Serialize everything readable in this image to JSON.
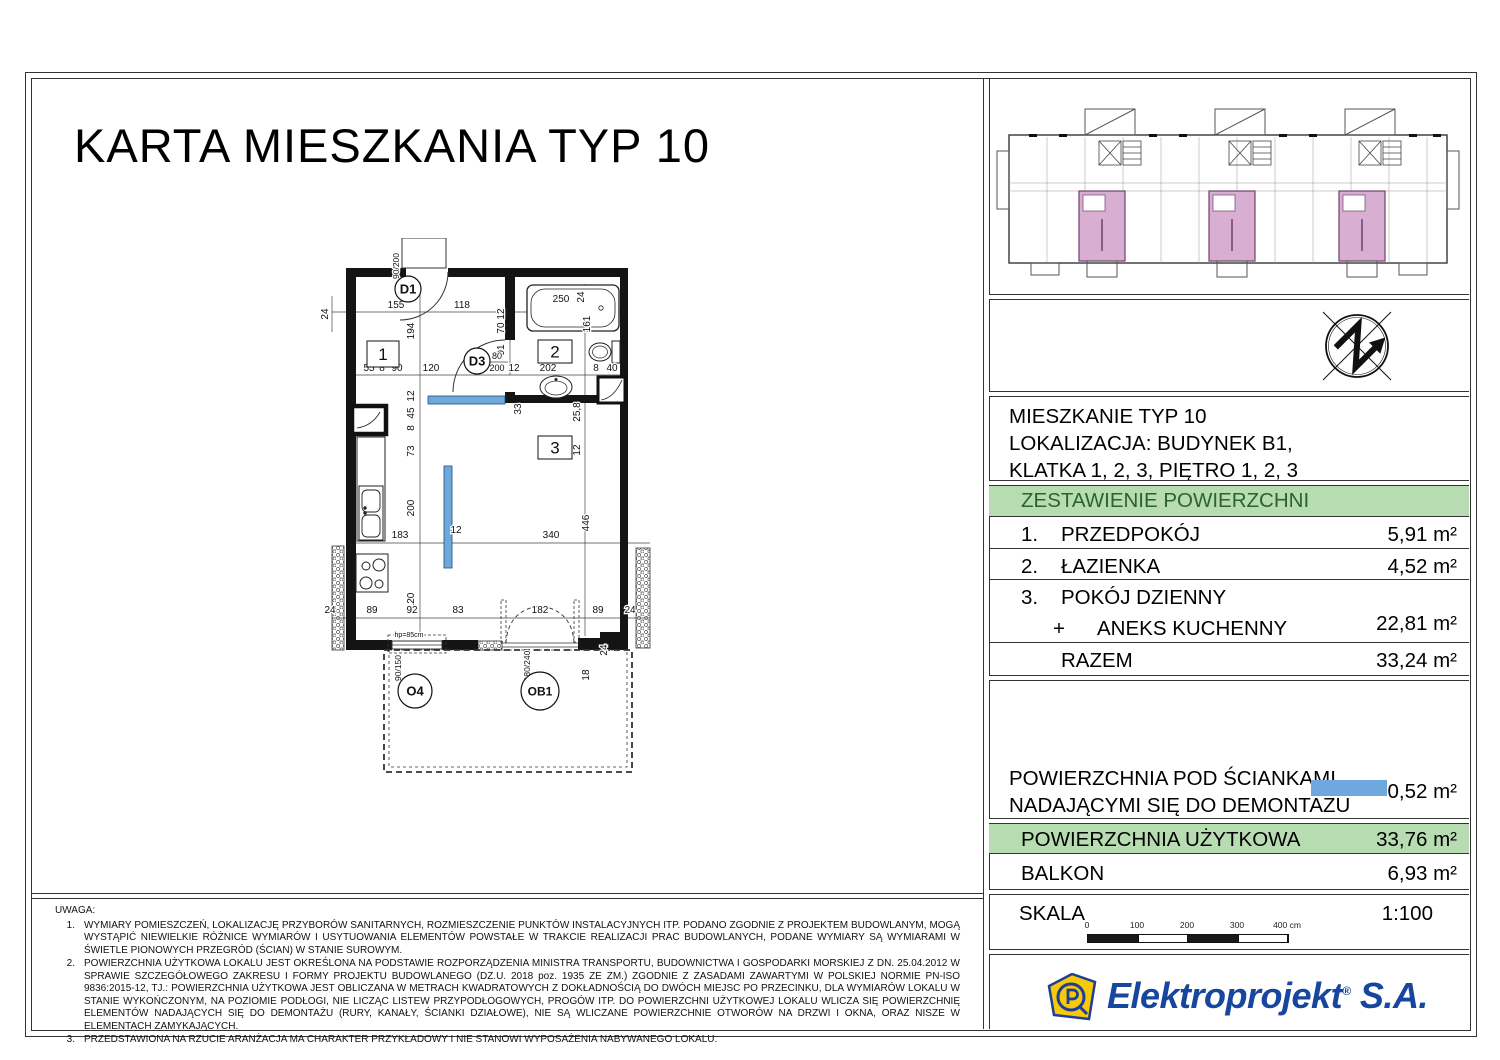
{
  "title": "KARTA MIESZKANIA TYP 10",
  "info": {
    "line1": "MIESZKANIE TYP 10",
    "line2": "LOKALIZACJA: BUDYNEK B1,",
    "line3": "KLATKA 1, 2, 3, PIĘTRO 1, 2, 3"
  },
  "area_table": {
    "header": "ZESTAWIENIE POWIERZCHNI",
    "rows": [
      {
        "no": "1.",
        "name": "PRZEDPOKÓJ",
        "value": "5,91 m²"
      },
      {
        "no": "2.",
        "name": "ŁAZIENKA",
        "value": "4,52 m²"
      },
      {
        "no": "3.",
        "name": "POKÓJ DZIENNY",
        "plus": "+",
        "name2": "ANEKS KUCHENNY",
        "value": "22,81 m²"
      }
    ],
    "razem_label": "RAZEM",
    "razem_value": "33,24 m²"
  },
  "demontaz": {
    "line1": "POWIERZCHNIA POD ŚCIANKAMI",
    "line2": "NADAJĄCYMI SIĘ DO DEMONTAŻU",
    "value": "0,52 m²"
  },
  "summary": {
    "uzytkowa_label": "POWIERZCHNIA UŻYTKOWA",
    "uzytkowa_value": "33,76 m²",
    "balkon_label": "BALKON",
    "balkon_value": "6,93 m²"
  },
  "skala": {
    "label": "SKALA",
    "value": "1:100",
    "ticks": [
      "0",
      "100",
      "200",
      "300",
      "400 cm"
    ]
  },
  "logo": {
    "name": "Elektroprojekt",
    "reg": "®",
    "suffix": " S.A."
  },
  "notes": {
    "heading": "UWAGA:",
    "items": [
      {
        "no": "1.",
        "text": "WYMIARY POMIESZCZEŃ, LOKALIZACJĘ PRZYBORÓW SANITARNYCH, ROZMIESZCZENIE PUNKTÓW INSTALACYJNYCH ITP. PODANO ZGODNIE Z PROJEKTEM BUDOWLANYM, MOGĄ WYSTĄPIĆ NIEWIELKIE RÓŻNICE WYMIARÓW I USYTUOWANIA ELEMENTÓW POWSTAŁE W TRAKCIE REALIZACJI PRAC BUDOWLANYCH, PODANE WYMIARY SĄ WYMIARAMI W ŚWIETLE PIONOWYCH PRZEGRÓD (ŚCIAN) W STANIE SUROWYM."
      },
      {
        "no": "2.",
        "text": "POWIERZCHNIA UŻYTKOWA LOKALU JEST OKREŚLONA NA PODSTAWIE ROZPORZĄDZENIA MINISTRA TRANSPORTU, BUDOWNICTWA I GOSPODARKI MORSKIEJ Z DN. 25.04.2012 W SPRAWIE SZCZEGÓŁOWEGO ZAKRESU I FORMY PROJEKTU BUDOWLANEGO (DZ.U. 2018 poz. 1935 ZE ZM.) ZGODNIE Z ZASADAMI ZAWARTYMI W POLSKIEJ NORMIE PN-ISO 9836:2015-12, TJ.: POWIERZCHNIA UŻYTKOWA JEST OBLICZANA W METRACH KWADRATOWYCH Z DOKŁADNOŚCIĄ DO DWÓCH MIEJSC PO PRZECINKU, DLA WYMIARÓW LOKALU W STANIE WYKOŃCZONYM, NA POZIOMIE PODŁOGI, NIE LICZĄC LISTEW PRZYPODŁOGOWYCH, PROGÓW ITP. DO POWIERZCHNI UŻYTKOWEJ LOKALU WLICZA SIĘ POWIERZCHNIĘ ELEMENTÓW NADAJĄCYCH SIĘ DO DEMONTAŻU (RURY, KANAŁY, ŚCIANKI DZIAŁOWE), NIE SĄ WLICZANE POWIERZCHNIE OTWORÓW NA DRZWI I OKNA, ORAZ NISZE W ELEMENTACH ZAMYKAJĄCYCH."
      },
      {
        "no": "3.",
        "text": "PRZEDSTAWIONA NA RZUCIE ARANŻACJA MA CHARAKTER PRZYKŁADOWY I NIE STANOWI WYPOSAŻENIA NABYWANEGO LOKALU."
      }
    ]
  },
  "plan": {
    "rooms": [
      {
        "t": "1",
        "x": 367,
        "y": 341,
        "w": 32,
        "h": 26
      },
      {
        "t": "2",
        "x": 538,
        "y": 340,
        "w": 34,
        "h": 23
      },
      {
        "t": "3",
        "x": 538,
        "y": 436,
        "w": 34,
        "h": 23
      }
    ],
    "openings": [
      {
        "t": "D1",
        "x": 408,
        "y": 289,
        "rr": 13
      },
      {
        "t": "D3",
        "x": 477,
        "y": 361,
        "rr": 13
      },
      {
        "t": "O4",
        "x": 415,
        "y": 691,
        "rr": 17
      },
      {
        "t": "OB1",
        "x": 540,
        "y": 691,
        "rr": 19
      }
    ],
    "dims": [
      {
        "t": "24",
        "x": 328,
        "y": 314,
        "r": -90
      },
      {
        "t": "155",
        "x": 396,
        "y": 308
      },
      {
        "t": "118",
        "x": 462,
        "y": 308
      },
      {
        "t": "250",
        "x": 561,
        "y": 302
      },
      {
        "t": "24",
        "x": 584,
        "y": 297,
        "r": -90
      },
      {
        "t": "90/200",
        "x": 399,
        "y": 266,
        "r": -90,
        "s": 8.5
      },
      {
        "t": "194",
        "x": 414,
        "y": 331,
        "r": -90
      },
      {
        "t": "12",
        "x": 504,
        "y": 314,
        "r": -90
      },
      {
        "t": "70",
        "x": 504,
        "y": 328,
        "r": -90
      },
      {
        "t": "91",
        "x": 504,
        "y": 350,
        "r": -90
      },
      {
        "t": "161",
        "x": 590,
        "y": 324,
        "r": -90
      },
      {
        "t": "55",
        "x": 369,
        "y": 371
      },
      {
        "t": "8",
        "x": 382,
        "y": 371
      },
      {
        "t": "90",
        "x": 397,
        "y": 371
      },
      {
        "t": "120",
        "x": 431,
        "y": 371
      },
      {
        "t": "80",
        "x": 497,
        "y": 359,
        "s": 9
      },
      {
        "t": "200",
        "x": 497,
        "y": 371,
        "s": 9
      },
      {
        "t": "12",
        "x": 514,
        "y": 371
      },
      {
        "t": "202",
        "x": 548,
        "y": 371
      },
      {
        "t": "8",
        "x": 596,
        "y": 371
      },
      {
        "t": "40",
        "x": 612,
        "y": 371
      },
      {
        "t": "33",
        "x": 521,
        "y": 409,
        "r": -90
      },
      {
        "t": "25,8",
        "x": 580,
        "y": 412,
        "r": -90
      },
      {
        "t": "12",
        "x": 580,
        "y": 450,
        "r": -90
      },
      {
        "t": "12",
        "x": 414,
        "y": 396,
        "r": -90
      },
      {
        "t": "45",
        "x": 414,
        "y": 413,
        "r": -90
      },
      {
        "t": "8",
        "x": 414,
        "y": 428,
        "r": -90
      },
      {
        "t": "73",
        "x": 414,
        "y": 451,
        "r": -90
      },
      {
        "t": "200",
        "x": 414,
        "y": 508,
        "r": -90
      },
      {
        "t": "120",
        "x": 414,
        "y": 601,
        "r": -90
      },
      {
        "t": "446",
        "x": 589,
        "y": 523,
        "r": -90
      },
      {
        "t": "183",
        "x": 400,
        "y": 538
      },
      {
        "t": "12",
        "x": 456,
        "y": 533
      },
      {
        "t": "340",
        "x": 551,
        "y": 538
      },
      {
        "t": "24",
        "x": 330,
        "y": 613
      },
      {
        "t": "89",
        "x": 372,
        "y": 613
      },
      {
        "t": "92",
        "x": 412,
        "y": 613
      },
      {
        "t": "83",
        "x": 458,
        "y": 613
      },
      {
        "t": "182",
        "x": 540,
        "y": 613
      },
      {
        "t": "89",
        "x": 598,
        "y": 613
      },
      {
        "t": "24",
        "x": 630,
        "y": 613
      },
      {
        "t": "hp=85cm",
        "x": 409,
        "y": 637,
        "s": 7
      },
      {
        "t": "90/150",
        "x": 401,
        "y": 668,
        "r": -90,
        "s": 8.5
      },
      {
        "t": "180/240",
        "x": 530,
        "y": 666,
        "r": -90,
        "s": 8.5
      },
      {
        "t": "18",
        "x": 589,
        "y": 675,
        "r": -90
      },
      {
        "t": "24",
        "x": 607,
        "y": 650,
        "r": -90
      }
    ]
  },
  "colors": {
    "green_bg": "#b8dcb2",
    "green_text": "#2a642a",
    "demountable_blue": "#6fa8dc",
    "keyplan_pink": "#d8aed2",
    "logo_blue": "#16469d",
    "logo_yellow": "#f8c80a"
  }
}
